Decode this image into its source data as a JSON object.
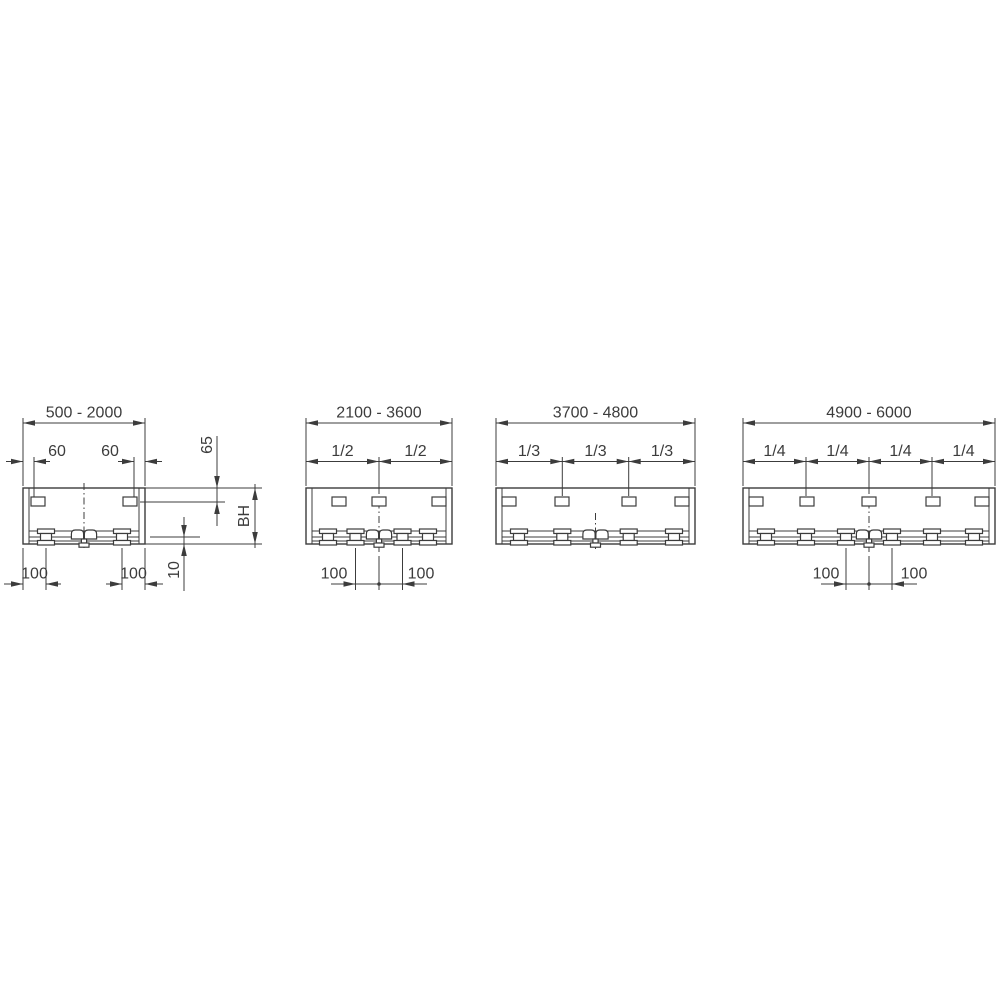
{
  "colors": {
    "line": "#3c3c3c",
    "background": "#ffffff"
  },
  "diagrams": [
    {
      "range_label": "500 - 2000",
      "clip_offset_labels": [
        "60",
        "60"
      ],
      "top_offset_label": "65",
      "height_label": "BH",
      "rail_offset_label": "10",
      "bottom_offset_labels": [
        "100",
        "100"
      ]
    },
    {
      "range_label": "2100 - 3600",
      "spacing_labels": [
        "1/2",
        "1/2"
      ],
      "bottom_offset_labels": [
        "100",
        "100"
      ]
    },
    {
      "range_label": "3700 - 4800",
      "spacing_labels": [
        "1/3",
        "1/3",
        "1/3"
      ]
    },
    {
      "range_label": "4900 - 6000",
      "spacing_labels": [
        "1/4",
        "1/4",
        "1/4",
        "1/4"
      ],
      "bottom_offset_labels": [
        "100",
        "100"
      ]
    }
  ]
}
